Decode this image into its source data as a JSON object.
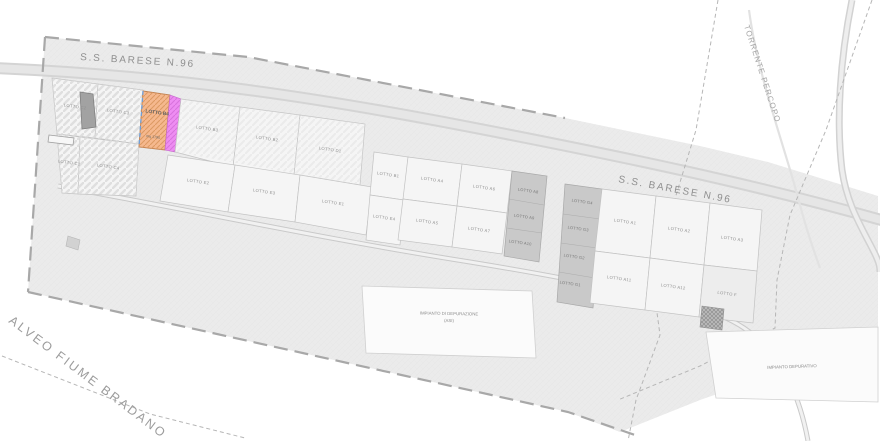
{
  "map_labels": {
    "road_top": "S.S. BARESE N.96",
    "road_right": "S.S. BARESE N.96",
    "stream": "TORRENTE PERCOPO",
    "river": "ALVEO FIUME BRADANO"
  },
  "facilities": {
    "treatment_plant_line1": "IMPIANTO DI DEPURAZIONE",
    "treatment_plant_line2": "(ASI)",
    "right_plant": "IMPIANTO DEPURATIVO"
  },
  "highlighted_lot": {
    "label": "LOTTO B4",
    "area": "mq 1790",
    "fill_color": "#f5b88e",
    "strip_color": "#ee8df2",
    "edge_color": "#6f9fd8"
  },
  "lots": {
    "c2": "LOTTO C2",
    "c3": "LOTTO C3",
    "c1": "LOTTO C1",
    "c4": "LOTTO C4",
    "b3": "LOTTO B3",
    "b2": "LOTTO B2",
    "d1": "LOTTO D1",
    "e2": "LOTTO E2",
    "e3": "LOTTO E3",
    "e1": "LOTTO E1",
    "b1": "LOTTO B1",
    "e4": "LOTTO E4",
    "a4": "LOTTO A4",
    "a6": "LOTTO A6",
    "a5": "LOTTO A5",
    "a7": "LOTTO A7",
    "a8": "LOTTO A8",
    "a9": "LOTTO A9",
    "a10": "LOTTO A10",
    "g4": "LOTTO G4",
    "g3": "LOTTO G3",
    "g2": "LOTTO G2",
    "g1": "LOTTO G1",
    "a1": "LOTTO A1",
    "a2": "LOTTO A2",
    "a3": "LOTTO A3",
    "a11": "LOTTO A11",
    "a12": "LOTTO A12",
    "f": "LOTTO F"
  }
}
